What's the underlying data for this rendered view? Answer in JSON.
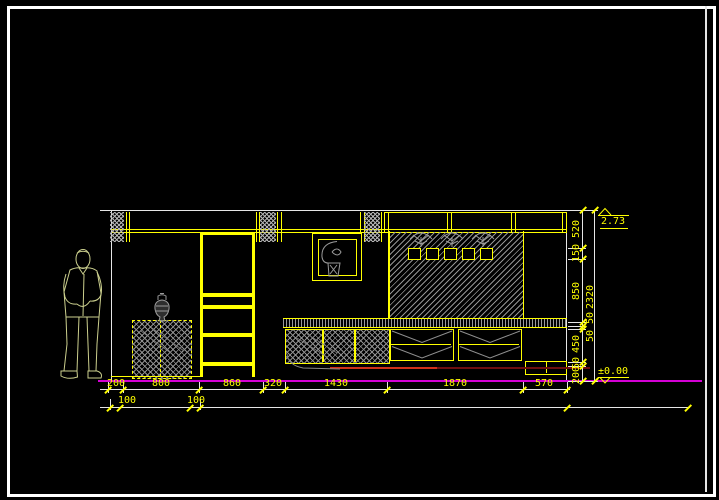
{
  "title": "interior elevation CAD drawing",
  "levels": {
    "top": "2.73",
    "bottom": "±0.00"
  },
  "dims": {
    "b1": [
      "200",
      "800",
      "860",
      "320",
      "1430",
      "1870",
      "570"
    ],
    "b2": [
      "100",
      "100"
    ],
    "v1": [
      "520",
      "150",
      "850",
      "450",
      "50",
      "200"
    ],
    "v2": [
      "2320",
      "50",
      "50"
    ]
  },
  "colors": {
    "line_yellow": "#ffff00",
    "line_white": "#e6e6e6",
    "ground_magenta": "#d400d4",
    "skirting_red": "#d03018",
    "hatch_gray": "#9a9a9a",
    "figure_outline": "#ccd08e"
  }
}
